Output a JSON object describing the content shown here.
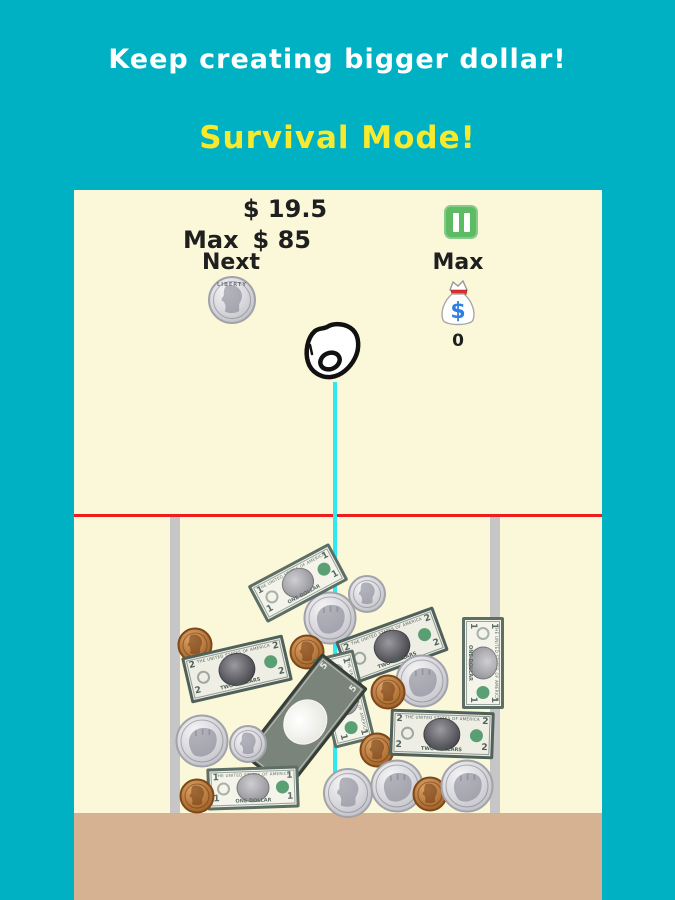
{
  "colors": {
    "background": "#00b1c3",
    "panel": "#fbf8da",
    "floor": "#d7b292",
    "red_line": "#ee1c1c",
    "drop_line": "#2ee9f2",
    "wall": "#c6c6c6",
    "pause_green": "#5dbb63",
    "title_white": "#ffffff",
    "mode_yellow": "#f6e92e",
    "text_dark": "#1f1f1f",
    "bag_red": "#d83030",
    "bag_blue": "#2f7fe0"
  },
  "header": {
    "title": "Keep creating bigger dollar!",
    "mode": "Survival Mode!"
  },
  "hud": {
    "score": "$ 19.5",
    "max_label": "Max",
    "max_value": "$ 85",
    "next_label": "Next",
    "next_coin": "quarter",
    "liberty_text": "LIBERTY",
    "right_max_label": "Max",
    "bag_symbol": "$",
    "bag_count": "0"
  },
  "pile": {
    "bill_types": {
      "bill1": {
        "label": "1 dollar bill",
        "w": 92,
        "h": 42,
        "body": "#f4f4ea",
        "ink": "#5c6e66",
        "corner": "1",
        "top_text": "THE UNITED STATES OF AMERICA",
        "bottom_text": "ONE DOLLAR",
        "portrait_dark": false,
        "inverted": false
      },
      "bill2": {
        "label": "2 dollar bill",
        "w": 104,
        "h": 47,
        "body": "#eeeee4",
        "ink": "#4f615a",
        "corner": "2",
        "top_text": "THE UNITED STATES OF AMERICA",
        "bottom_text": "TWO DOLLARS",
        "portrait_dark": true,
        "inverted": false
      },
      "bill5": {
        "label": "5 dollar bill",
        "w": 130,
        "h": 58,
        "body": "#7b847b",
        "ink": "#353e37",
        "corner": "5",
        "top_text": "",
        "bottom_text": "",
        "portrait_dark": false,
        "inverted": true
      }
    },
    "coin_types": {
      "quarter": {
        "label": "quarter coin",
        "d": 50,
        "face": "silver",
        "glyph": "profile"
      },
      "half": {
        "label": "half dollar coin",
        "d": 53,
        "face": "silver",
        "glyph": "fist"
      },
      "dime": {
        "label": "dime coin",
        "d": 38,
        "face": "silver",
        "glyph": "profile"
      },
      "penny": {
        "label": "penny coin",
        "d": 35,
        "face": "copper",
        "glyph": "profile"
      }
    },
    "items": [
      {
        "type": "dime",
        "x": 367,
        "y": 594,
        "rot": 0
      },
      {
        "type": "half",
        "x": 330,
        "y": 618,
        "rot": 0
      },
      {
        "type": "bill1",
        "x": 298,
        "y": 583,
        "rot": -28
      },
      {
        "type": "bill2",
        "x": 392,
        "y": 646,
        "rot": -20
      },
      {
        "type": "penny",
        "x": 195,
        "y": 645,
        "rot": 0
      },
      {
        "type": "bill2",
        "x": 237,
        "y": 669,
        "rot": -13
      },
      {
        "type": "penny",
        "x": 307,
        "y": 652,
        "rot": 0
      },
      {
        "type": "bill1",
        "x": 483,
        "y": 663,
        "rot": 90
      },
      {
        "type": "half",
        "x": 422,
        "y": 681,
        "rot": 0
      },
      {
        "type": "penny",
        "x": 388,
        "y": 692,
        "rot": 0
      },
      {
        "type": "bill1",
        "x": 344,
        "y": 699,
        "rot": 76
      },
      {
        "type": "bill5",
        "x": 305,
        "y": 722,
        "rot": -52
      },
      {
        "type": "half",
        "x": 202,
        "y": 741,
        "rot": 0
      },
      {
        "type": "dime",
        "x": 248,
        "y": 744,
        "rot": 0
      },
      {
        "type": "penny",
        "x": 377,
        "y": 750,
        "rot": 0
      },
      {
        "type": "bill2",
        "x": 442,
        "y": 734,
        "rot": 2
      },
      {
        "type": "bill1",
        "x": 253,
        "y": 788,
        "rot": -2
      },
      {
        "type": "penny",
        "x": 197,
        "y": 796,
        "rot": 0
      },
      {
        "type": "quarter",
        "x": 348,
        "y": 793,
        "rot": 0
      },
      {
        "type": "half",
        "x": 397,
        "y": 786,
        "rot": 0
      },
      {
        "type": "penny",
        "x": 430,
        "y": 794,
        "rot": 0
      },
      {
        "type": "half",
        "x": 467,
        "y": 786,
        "rot": 0
      }
    ]
  }
}
